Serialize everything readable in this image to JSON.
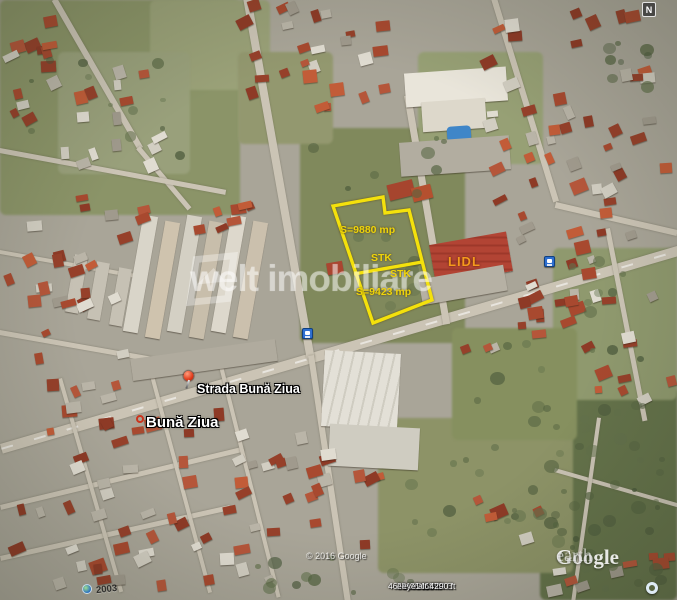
{
  "map": {
    "compass_label": "N",
    "parcel_annotations": {
      "area_top": "S=9880 mp",
      "marker_top": "STK",
      "marker_bottom": "STK",
      "area_bottom": "S=9423 mp"
    },
    "poi": {
      "store_label": "LIDL",
      "street_label": "Strada Bună Ziua",
      "district_label": "Bună Ziua"
    },
    "watermark_text": "welt imobiliare",
    "imagery_year": "2003",
    "copyright": "© 2016 Google",
    "logo": {
      "word1": "Google",
      "word2": "earth"
    },
    "status_bar": {
      "latitude": "46°44'59.61\" N",
      "longitude": "23°36'11.63\" E",
      "elevation": "elev 1468 ft",
      "eye_altitude": "eye alt 4290 ft"
    },
    "accent_colors": {
      "parcel_outline": "#f4e10c",
      "parcel_text": "#efd40a",
      "store_text": "#f59a1d"
    }
  }
}
